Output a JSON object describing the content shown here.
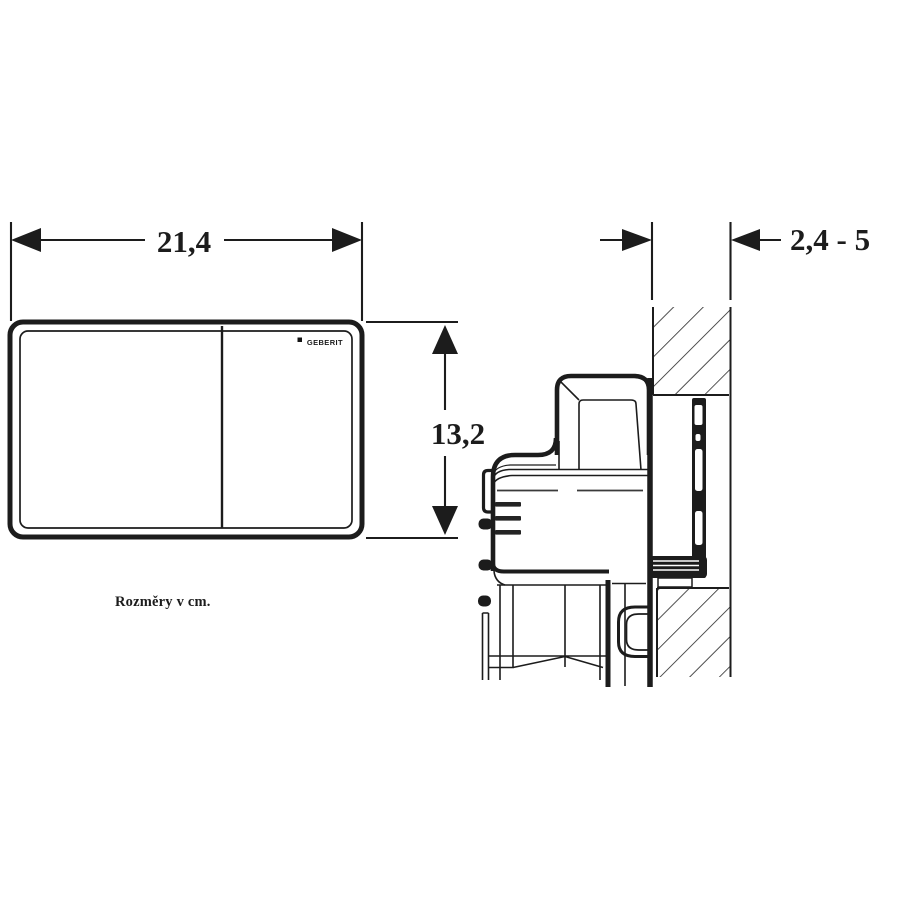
{
  "labels": {
    "plate_width": "21,4",
    "plate_height": "13,2",
    "wall_thickness_range": "2,4 - 5",
    "units_note": "Rozměry v cm.",
    "brand": "GEBERIT"
  },
  "colors": {
    "line": "#1c1c1c",
    "background": "#ffffff"
  }
}
